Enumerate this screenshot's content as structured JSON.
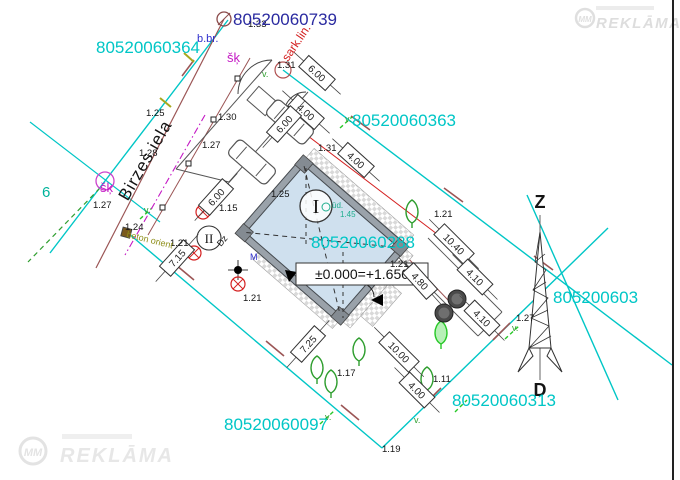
{
  "palette": {
    "black": "#141414",
    "cyan": "#00c6c6",
    "navy": "#2a2aa0",
    "blue": "#2d2dcc",
    "magenta": "#c419c4",
    "red": "#d42020",
    "maroon": "#9b5555",
    "olive": "#8f8f1a",
    "green": "#2f9e2f",
    "brightgreen": "#28c828",
    "teal": "#1fae8e",
    "teal2": "#00b39b",
    "wall": "#9aa2aa",
    "buildingfill": "#cfe0ee",
    "dim": "#333333",
    "watermark": "#e2e2e2"
  },
  "street": {
    "name": "Birzes iela"
  },
  "compass": {
    "north": "Z",
    "south": "D"
  },
  "building": {
    "number_label": "I",
    "aux_label": "II",
    "level_mark": "±0.000=+1.650"
  },
  "watermark": {
    "logo": "MM",
    "brand": "REKLĀMA"
  },
  "annotations": {
    "parcel_numbers": [
      {
        "t": "80520060364",
        "x": 96,
        "y": 53,
        "c": "cyan"
      },
      {
        "t": "80520060739",
        "x": 233,
        "y": 25,
        "c": "navy"
      },
      {
        "t": "80520060363",
        "x": 352,
        "y": 126,
        "c": "cyan"
      },
      {
        "t": "80520060288",
        "x": 311,
        "y": 248,
        "c": "cyan"
      },
      {
        "t": "80520060097",
        "x": 224,
        "y": 430,
        "c": "cyan"
      },
      {
        "t": "80520060313",
        "x": 452,
        "y": 406,
        "c": "cyan"
      },
      {
        "t": "805200603",
        "x": 553,
        "y": 303,
        "c": "cyan"
      }
    ],
    "labels": [
      {
        "t": "1.33",
        "x": 248,
        "y": 27
      },
      {
        "t": "1.25",
        "x": 146,
        "y": 116
      },
      {
        "t": "1.30",
        "x": 218,
        "y": 120
      },
      {
        "t": "1.27",
        "x": 202,
        "y": 148
      },
      {
        "t": "1.28",
        "x": 139,
        "y": 156
      },
      {
        "t": "1.27",
        "x": 93,
        "y": 208
      },
      {
        "t": "1.31",
        "x": 277,
        "y": 68
      },
      {
        "t": "1.31",
        "x": 318,
        "y": 151
      },
      {
        "t": "1.25",
        "x": 271,
        "y": 197
      },
      {
        "t": "1.15",
        "x": 219,
        "y": 211
      },
      {
        "t": "1.24",
        "x": 125,
        "y": 230
      },
      {
        "t": "1.21",
        "x": 170,
        "y": 246
      },
      {
        "t": "1.21",
        "x": 243,
        "y": 301
      },
      {
        "t": "1.21",
        "x": 434,
        "y": 217
      },
      {
        "t": "1.21",
        "x": 390,
        "y": 267
      },
      {
        "t": "1.27",
        "x": 516,
        "y": 321
      },
      {
        "t": "1.17",
        "x": 337,
        "y": 376
      },
      {
        "t": "1.11",
        "x": 433,
        "y": 382
      },
      {
        "t": "1.19",
        "x": 382,
        "y": 452
      },
      {
        "t": "ūd.",
        "x": 332,
        "y": 208,
        "c": "teal",
        "s": 8
      },
      {
        "t": "1.45",
        "x": 340,
        "y": 217,
        "c": "teal",
        "s": 8
      },
      {
        "t": "šķ",
        "x": 227,
        "y": 62,
        "c": "magenta",
        "s": 13
      },
      {
        "t": "šķ",
        "x": 100,
        "y": 192,
        "c": "magenta",
        "s": 13
      },
      {
        "t": "b.br.",
        "x": 197,
        "y": 42,
        "c": "blue",
        "s": 11
      },
      {
        "t": "6",
        "x": 42,
        "y": 197,
        "c": "teal2",
        "s": 15
      },
      {
        "t": "beton orient",
        "x": 126,
        "y": 237,
        "c": "olive",
        "s": 9,
        "r": 14
      },
      {
        "t": "sark.lin.",
        "x": 288,
        "y": 62,
        "c": "red",
        "s": 12,
        "r": -56
      },
      {
        "t": "Dz",
        "x": 221,
        "y": 247,
        "s": 9,
        "r": -50
      },
      {
        "t": "M",
        "x": 250,
        "y": 260,
        "c": "blue",
        "s": 9
      },
      {
        "t": "v.",
        "x": 345,
        "y": 122,
        "c": "green",
        "s": 9
      },
      {
        "t": "v.",
        "x": 144,
        "y": 213,
        "c": "green",
        "s": 9
      },
      {
        "t": "v.",
        "x": 512,
        "y": 331,
        "c": "green",
        "s": 9
      },
      {
        "t": "v.",
        "x": 325,
        "y": 420,
        "c": "green",
        "s": 9
      },
      {
        "t": "v.",
        "x": 262,
        "y": 77,
        "c": "green",
        "s": 9
      },
      {
        "t": "v.",
        "x": 414,
        "y": 423,
        "c": "green",
        "s": 9
      }
    ],
    "dimensions": [
      {
        "t": "6.00",
        "x": 317,
        "y": 73,
        "r": 42
      },
      {
        "t": "4.00",
        "x": 306,
        "y": 112,
        "r": 42
      },
      {
        "t": "6.00",
        "x": 284,
        "y": 124,
        "r": -48
      },
      {
        "t": "4.00",
        "x": 356,
        "y": 160,
        "r": 42
      },
      {
        "t": "6.00",
        "x": 216,
        "y": 197,
        "r": -48
      },
      {
        "t": "7.15",
        "x": 177,
        "y": 258,
        "r": -48
      },
      {
        "t": "10.40",
        "x": 454,
        "y": 244,
        "r": 45
      },
      {
        "t": "4.80",
        "x": 420,
        "y": 281,
        "r": 48
      },
      {
        "t": "4.10",
        "x": 475,
        "y": 277,
        "r": 45
      },
      {
        "t": "4.10",
        "x": 482,
        "y": 318,
        "r": 45
      },
      {
        "t": "10.00",
        "x": 399,
        "y": 352,
        "r": 45
      },
      {
        "t": "7.25",
        "x": 308,
        "y": 344,
        "r": -48
      },
      {
        "t": "4.00",
        "x": 417,
        "y": 390,
        "r": 45
      }
    ],
    "trees": [
      {
        "x": 412,
        "y": 212
      },
      {
        "x": 317,
        "y": 368
      },
      {
        "x": 331,
        "y": 382
      },
      {
        "x": 359,
        "y": 350
      },
      {
        "x": 427,
        "y": 379
      },
      {
        "x": 441,
        "y": 333,
        "bright": true
      }
    ],
    "felled_marks": [
      {
        "x": 203,
        "y": 212
      },
      {
        "x": 194,
        "y": 253
      },
      {
        "x": 238,
        "y": 284
      }
    ],
    "manholes": [
      {
        "x": 444,
        "y": 313
      },
      {
        "x": 457,
        "y": 299
      }
    ]
  }
}
